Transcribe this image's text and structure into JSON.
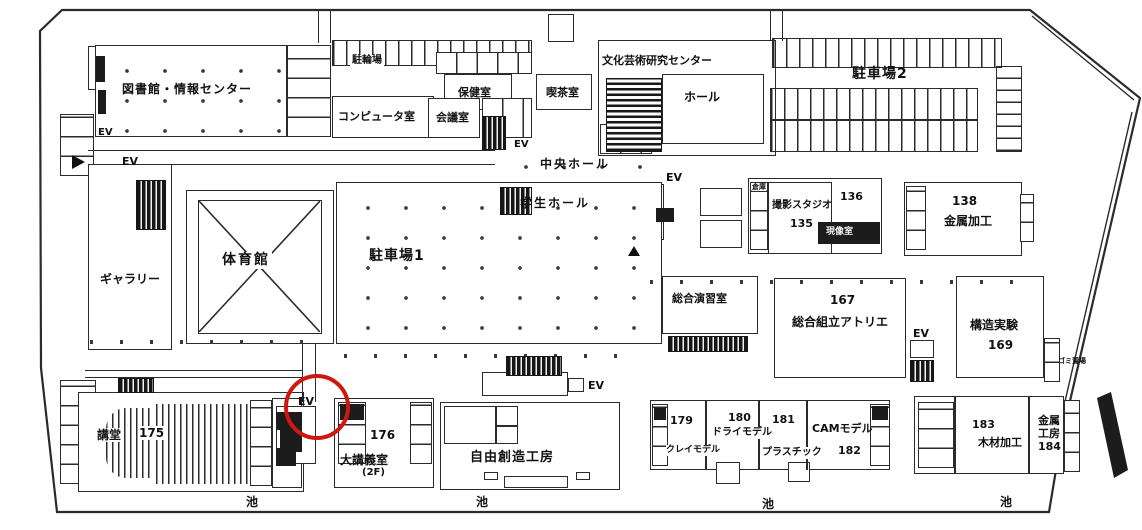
{
  "map": {
    "title": "campus first floor plan (scanned)",
    "colors": {
      "wall": "#2b2b2b",
      "paper": "#ffffff",
      "highlight_circle": "#cd1710"
    },
    "annotation": {
      "highlighted_item": "EV",
      "shape": "red-circle"
    },
    "labels": {
      "ev": "EV",
      "pond": "池",
      "library": "図書館・情報センター",
      "bike_parking": "駐輪場",
      "computer_room": "コンピュータ室",
      "meeting_room": "会議室",
      "health_room": "保健室",
      "cafe": "喫茶室",
      "culture_center": "文化芸術研究センター",
      "hall": "ホール",
      "parking2": "駐車場2",
      "central_hall": "中央ホール",
      "student_hall": "学生ホール",
      "gym": "体育館",
      "gallery": "ギャラリー",
      "parking1": "駐車場1",
      "storage": "倉庫",
      "photo_studio": "撮影スタジオ",
      "room135": "135",
      "room136": "136",
      "darkroom": "現像室",
      "room138": "138",
      "metal_processing": "金属加工",
      "seminar_room": "総合演習室",
      "room167": "167",
      "atelier": "総合組立アトリエ",
      "structure_lab": "構造実験",
      "room169": "169",
      "trash_area": "ゴミ置場",
      "auditorium": "講堂",
      "room175": "175",
      "room176": "176",
      "lecture_room": "大講義室",
      "lecture_room_floor": "(2F)",
      "workshop": "自由創造工房",
      "room179": "179",
      "room180": "180",
      "room181": "181",
      "clay_model": "クレイモデル",
      "dry_model": "ドライモデル",
      "plastic": "プラスチック",
      "cam_model": "CAMモデル",
      "room182": "182",
      "room183": "183",
      "wood_processing": "木材加工",
      "metal_workshop_stack": "金属\n工房\n184"
    }
  }
}
